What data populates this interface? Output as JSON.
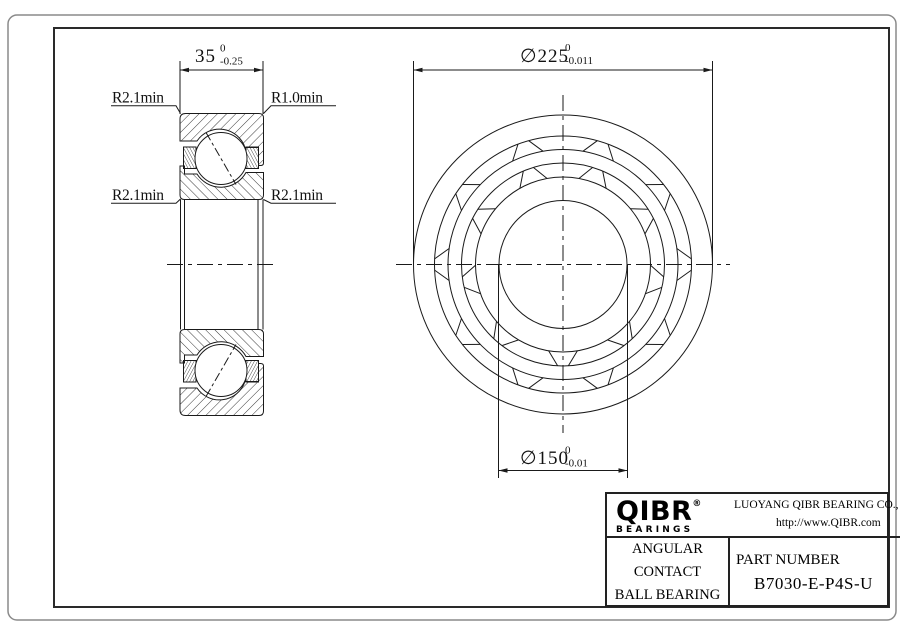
{
  "page": {
    "bg": "#ffffff",
    "line_color": "#1a1a1a",
    "border_color": "#8a8a8a"
  },
  "section_view": {
    "width_dim": {
      "value": "35",
      "tol_upper": "0",
      "tol_lower": "-0.25"
    },
    "label_top_left": "R2.1min",
    "label_top_right": "R1.0min",
    "label_mid_left": "R2.1min",
    "label_mid_right": "R2.1min"
  },
  "front_view": {
    "od_dim": {
      "value": "∅225",
      "tol_upper": "0",
      "tol_lower": "-0.011"
    },
    "bore_dim": {
      "value": "∅150",
      "tol_upper": "0",
      "tol_lower": "-0.01"
    }
  },
  "title_block": {
    "logo_text": "QIBR",
    "logo_reg": "®",
    "logo_sub": "BEARINGS",
    "company": "LUOYANG QIBR BEARING CO., LTD",
    "website": "http://www.QIBR.com",
    "product_line1": "ANGULAR CONTACT",
    "product_line2": "BALL BEARING",
    "part_number_label": "PART NUMBER",
    "part_number": "B7030-E-P4S-U"
  }
}
